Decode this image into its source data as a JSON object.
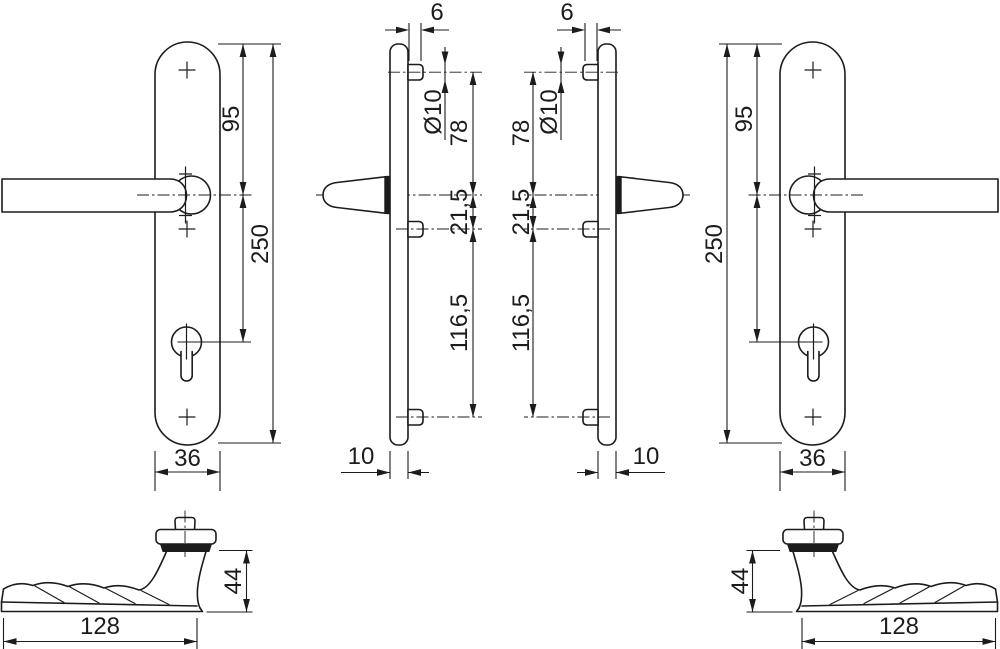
{
  "drawing": {
    "background_color": "#ffffff",
    "line_color": "#1c1c1c",
    "dimensions": {
      "plate_length": "250",
      "top_to_handle_center": "95",
      "plate_width": "36",
      "pin_protrusion": "6",
      "pin_diameter": "Ø10",
      "top_pin_to_handle": "78",
      "handle_to_screw": "21,5",
      "screw_to_bottom_pin": "116,5",
      "plate_thickness": "10",
      "handle_length": "128",
      "handle_height": "44"
    }
  }
}
